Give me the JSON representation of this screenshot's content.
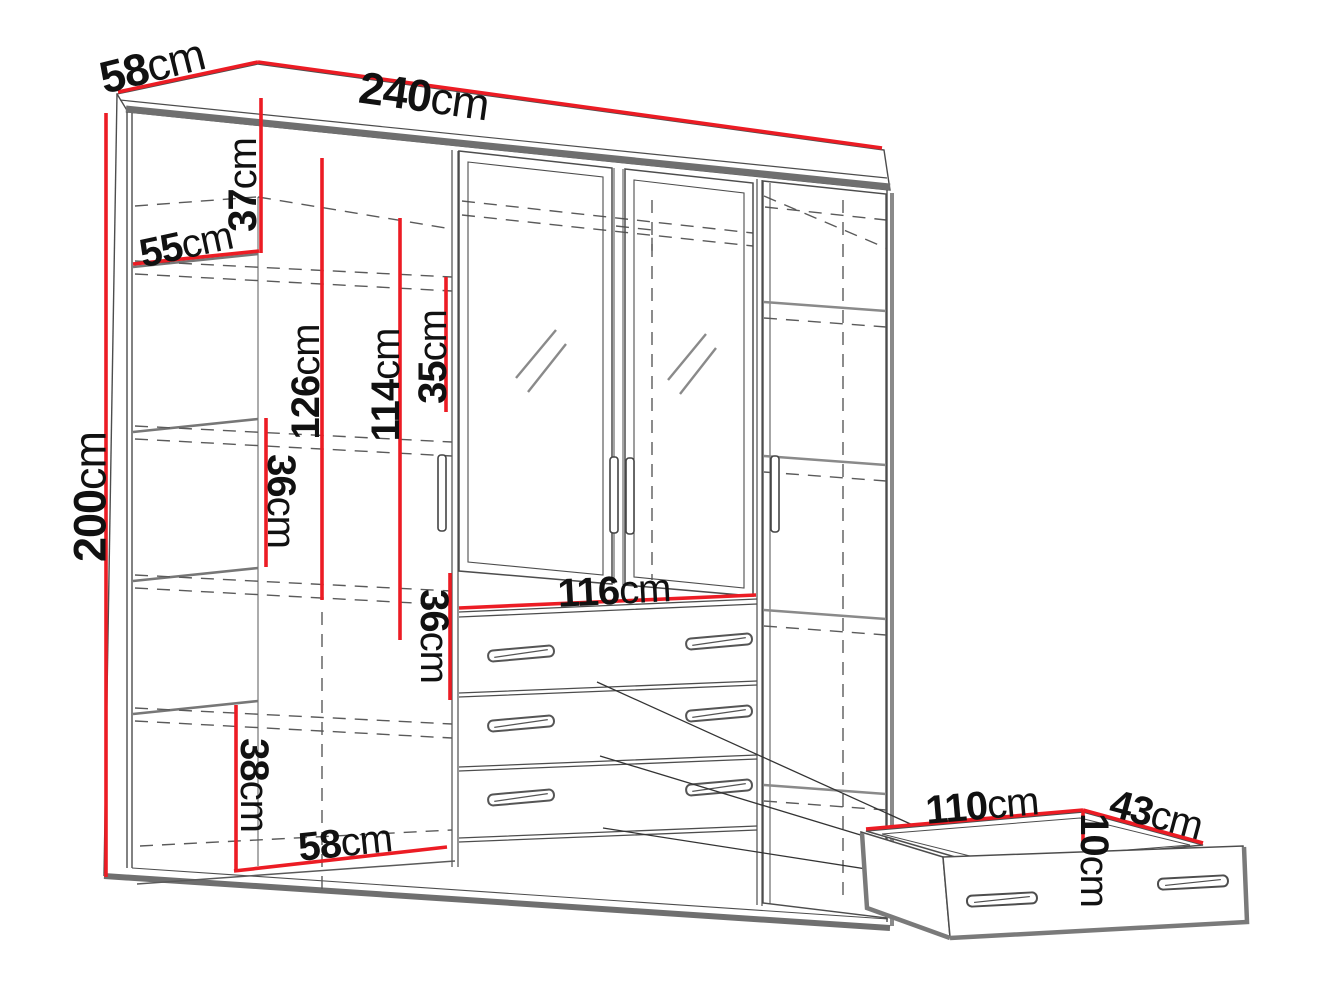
{
  "diagram": {
    "type": "furniture-dimension-diagram",
    "subject": "four-door wardrobe with two mirrored doors, interior shelves and three drawers, plus detached drawer detail",
    "unit": "cm",
    "colors": {
      "dimension_line": "#ec1c24",
      "outline": "#4d4d4d",
      "thick_edge": "#6f6f6f",
      "text": "#111111",
      "background": "#ffffff"
    },
    "dims": {
      "width": {
        "value": "240",
        "unit": "cm"
      },
      "depth_top": {
        "value": "58",
        "unit": "cm"
      },
      "height": {
        "value": "200",
        "unit": "cm"
      },
      "top_gap": {
        "value": "37",
        "unit": "cm"
      },
      "inner_depth": {
        "value": "55",
        "unit": "cm"
      },
      "hanging": {
        "value": "126",
        "unit": "cm"
      },
      "rail": {
        "value": "114",
        "unit": "cm"
      },
      "mirror_gap": {
        "value": "35",
        "unit": "cm"
      },
      "shelf_gap": {
        "value": "36",
        "unit": "cm"
      },
      "drawer_sec": {
        "value": "36",
        "unit": "cm"
      },
      "drawers_w": {
        "value": "116",
        "unit": "cm"
      },
      "bottom_gap": {
        "value": "38",
        "unit": "cm"
      },
      "door_w": {
        "value": "58",
        "unit": "cm"
      },
      "drawer_w": {
        "value": "110",
        "unit": "cm"
      },
      "drawer_d": {
        "value": "43",
        "unit": "cm"
      },
      "drawer_h": {
        "value": "10",
        "unit": "cm"
      }
    }
  }
}
